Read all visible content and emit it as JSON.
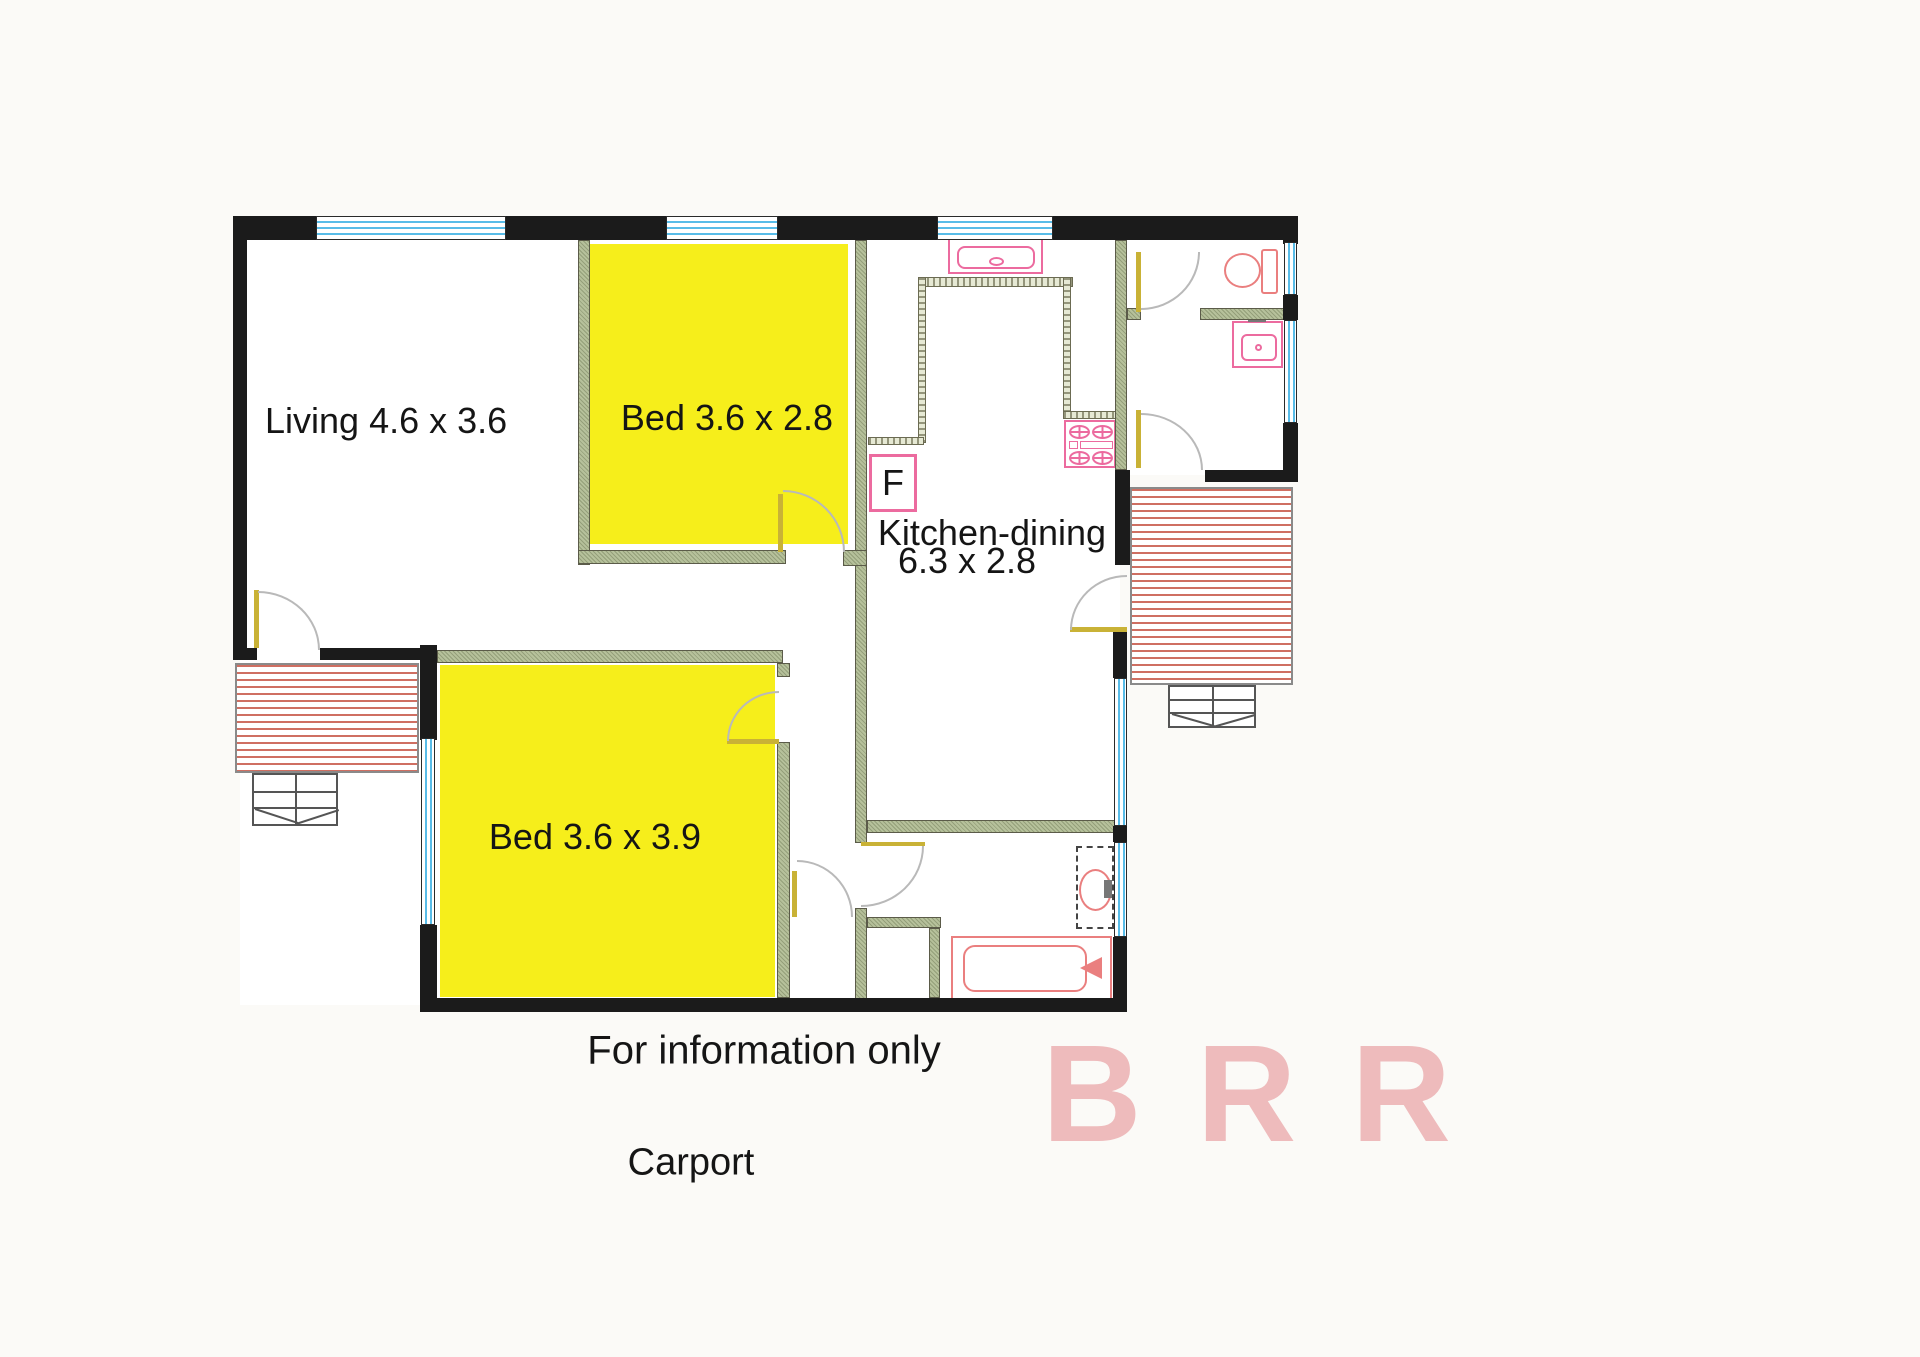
{
  "document": {
    "kind": "scanned floor plan"
  },
  "rooms": {
    "living": {
      "label": "Living 4.6 x 3.6"
    },
    "bed1": {
      "label": "Bed 3.6 x 2.8"
    },
    "bed2": {
      "label": "Bed 3.6 x 3.9"
    },
    "kitchen_dining": {
      "label": "Kitchen-dining",
      "dimensions": "6.3 x 2.8"
    }
  },
  "fixtures": {
    "fridge_label": "F"
  },
  "annotations": {
    "info_note": "For information only",
    "carport": "Carport"
  },
  "watermark": {
    "text": "BRR",
    "color": "#eebbbc"
  },
  "colors": {
    "room_highlight": "#f6ee1b",
    "wall_exterior": "#1b1b1b",
    "wall_partition": "#b6c19b",
    "window_blue": "#58bce8",
    "fixture_pink": "#ec6b9f",
    "fixture_red": "#ea7f7f",
    "deck_stripe": "#cf6f62",
    "door_leaf": "#c9b236"
  }
}
